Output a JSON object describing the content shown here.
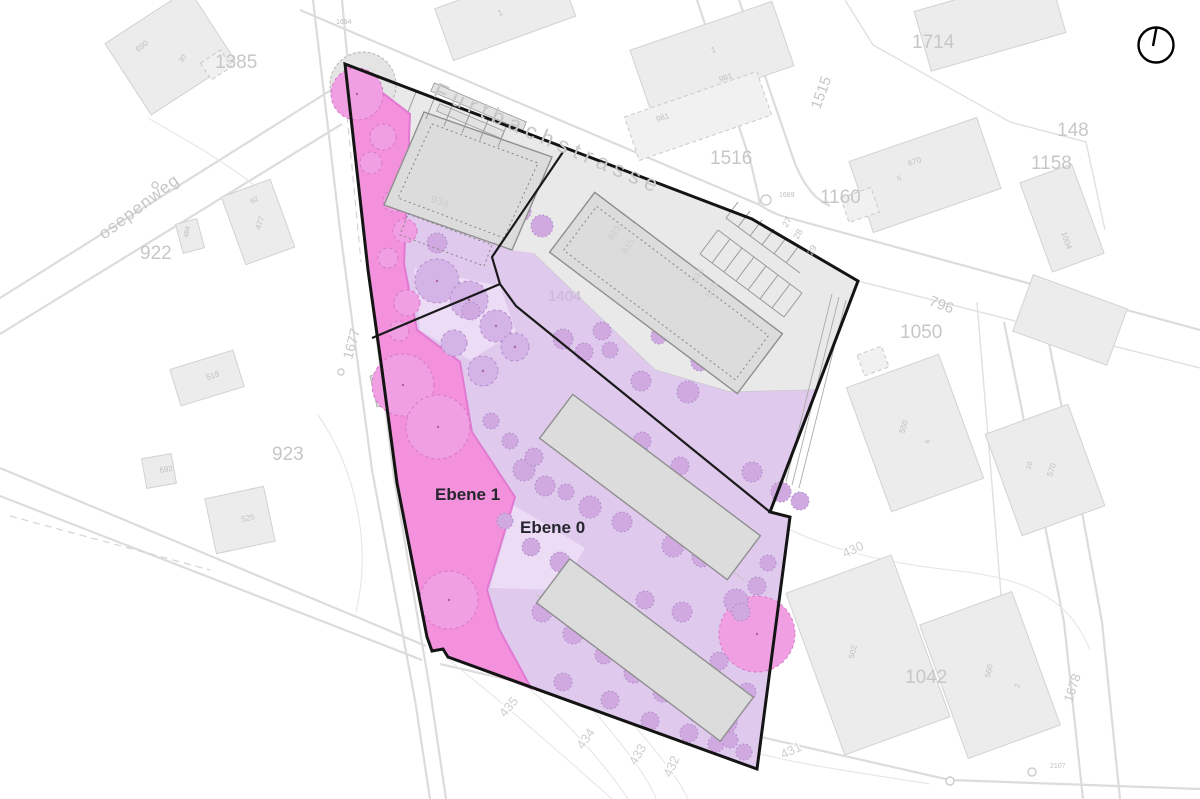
{
  "page": {
    "type": "architectural-site-plan"
  },
  "levels": {
    "ebene1": "Ebene 1",
    "ebene0": "Ebene 0"
  },
  "streets": {
    "furtbachstrasse": "Furtbachstrasse",
    "sidestreet": "osepenweg"
  },
  "parcels": {
    "p1385": "1385",
    "p1516": "1516",
    "p1160": "1160",
    "p1714": "1714",
    "p1158": "1158",
    "p148": "148",
    "p922": "922",
    "p923": "923",
    "p1050": "1050",
    "p1042": "1042",
    "p1404": "1404",
    "p796": "796",
    "p1515": "1515",
    "p1677": "1677",
    "p1678": "1678"
  },
  "map_labels": [
    {
      "t": "690",
      "x": 138,
      "y": 52,
      "s": 8,
      "r": -35
    },
    {
      "t": "30",
      "x": 182,
      "y": 63,
      "s": 7,
      "r": -55
    },
    {
      "t": "1",
      "x": 499,
      "y": 16,
      "s": 8,
      "r": -20
    },
    {
      "t": "1",
      "x": 712,
      "y": 53,
      "s": 8,
      "r": -18
    },
    {
      "t": "981",
      "x": 720,
      "y": 82,
      "s": 8,
      "r": -18
    },
    {
      "t": "981",
      "x": 657,
      "y": 122,
      "s": 8,
      "r": -18
    },
    {
      "t": "670",
      "x": 909,
      "y": 166,
      "s": 8,
      "r": -18
    },
    {
      "t": "5",
      "x": 898,
      "y": 181,
      "s": 7,
      "r": -18
    },
    {
      "t": "1004",
      "x": 1061,
      "y": 233,
      "s": 8,
      "r": 70
    },
    {
      "t": "82",
      "x": 252,
      "y": 204,
      "s": 7,
      "r": -30
    },
    {
      "t": "477",
      "x": 260,
      "y": 230,
      "s": 8,
      "r": -70
    },
    {
      "t": "484",
      "x": 188,
      "y": 238,
      "s": 7,
      "r": -80
    },
    {
      "t": "518",
      "x": 207,
      "y": 380,
      "s": 8,
      "r": -17
    },
    {
      "t": "525",
      "x": 242,
      "y": 522,
      "s": 8,
      "r": -12
    },
    {
      "t": "692",
      "x": 160,
      "y": 473,
      "s": 8,
      "r": -10
    },
    {
      "t": "550",
      "x": 904,
      "y": 434,
      "s": 8,
      "r": -72
    },
    {
      "t": "6",
      "x": 929,
      "y": 444,
      "s": 7,
      "r": -72
    },
    {
      "t": "570",
      "x": 1052,
      "y": 477,
      "s": 8,
      "r": -72
    },
    {
      "t": "10",
      "x": 1030,
      "y": 470,
      "s": 7,
      "r": -72
    },
    {
      "t": "502",
      "x": 854,
      "y": 659,
      "s": 8,
      "r": -78
    },
    {
      "t": "560",
      "x": 990,
      "y": 678,
      "s": 8,
      "r": -78
    },
    {
      "t": "2",
      "x": 1019,
      "y": 688,
      "s": 7,
      "r": -78
    },
    {
      "t": "1694",
      "x": 336,
      "y": 24,
      "s": 7,
      "r": 0
    },
    {
      "t": "1689",
      "x": 779,
      "y": 197,
      "s": 7,
      "r": 0
    },
    {
      "t": "2107",
      "x": 1050,
      "y": 768,
      "s": 7,
      "r": 0
    },
    {
      "t": "27",
      "x": 787,
      "y": 228,
      "s": 9,
      "r": -60
    },
    {
      "t": "28",
      "x": 798,
      "y": 240,
      "s": 9,
      "r": -60
    },
    {
      "t": "29",
      "x": 812,
      "y": 256,
      "s": 9,
      "r": -60
    },
    {
      "t": "93a",
      "x": 430,
      "y": 202,
      "s": 11,
      "r": 18,
      "c": "faint"
    },
    {
      "t": "B15",
      "x": 612,
      "y": 241,
      "s": 9,
      "r": -58,
      "c": "faint"
    },
    {
      "t": "B15",
      "x": 626,
      "y": 255,
      "s": 9,
      "r": -58,
      "c": "faint"
    },
    {
      "t": "B15",
      "x": 696,
      "y": 284,
      "s": 9,
      "r": -58,
      "c": "faint"
    },
    {
      "t": "B15",
      "x": 710,
      "y": 298,
      "s": 9,
      "r": -58,
      "c": "faint"
    },
    {
      "t": "435",
      "x": 505,
      "y": 718,
      "s": 13,
      "r": -50,
      "c": "contour"
    },
    {
      "t": "434",
      "x": 583,
      "y": 750,
      "s": 13,
      "r": -55,
      "c": "contour"
    },
    {
      "t": "433",
      "x": 636,
      "y": 766,
      "s": 13,
      "r": -60,
      "c": "contour"
    },
    {
      "t": "432",
      "x": 671,
      "y": 778,
      "s": 13,
      "r": -66,
      "c": "contour"
    },
    {
      "t": "431",
      "x": 783,
      "y": 759,
      "s": 13,
      "r": -25,
      "c": "contour"
    },
    {
      "t": "430",
      "x": 845,
      "y": 558,
      "s": 13,
      "r": -25,
      "c": "contour"
    }
  ],
  "trees": {
    "pink": [
      [
        357,
        94,
        26
      ],
      [
        383,
        137,
        13
      ],
      [
        371,
        163,
        11
      ],
      [
        394,
        201,
        11
      ],
      [
        405,
        231,
        12
      ],
      [
        388,
        258,
        10
      ],
      [
        407,
        303,
        13
      ],
      [
        399,
        331,
        10
      ],
      [
        403,
        385,
        31
      ],
      [
        438,
        427,
        32
      ],
      [
        449,
        600,
        29
      ],
      [
        757,
        634,
        38
      ]
    ],
    "purple_big": [
      [
        437,
        281,
        22
      ],
      [
        469,
        300,
        19
      ],
      [
        496,
        326,
        16
      ],
      [
        454,
        343,
        13
      ],
      [
        515,
        347,
        14
      ],
      [
        483,
        371,
        15
      ]
    ],
    "purple_small": [
      [
        466,
        190,
        10
      ],
      [
        452,
        216,
        11
      ],
      [
        437,
        243,
        10
      ],
      [
        499,
        196,
        12
      ],
      [
        520,
        211,
        11
      ],
      [
        542,
        226,
        11
      ],
      [
        563,
        339,
        10
      ],
      [
        584,
        352,
        9
      ],
      [
        610,
        350,
        8
      ],
      [
        641,
        381,
        10
      ],
      [
        688,
        392,
        11
      ],
      [
        471,
        311,
        9
      ],
      [
        602,
        331,
        9
      ],
      [
        659,
        336,
        8
      ],
      [
        700,
        362,
        9
      ],
      [
        524,
        470,
        11
      ],
      [
        545,
        486,
        10
      ],
      [
        590,
        507,
        11
      ],
      [
        622,
        522,
        10
      ],
      [
        673,
        546,
        11
      ],
      [
        702,
        557,
        10
      ],
      [
        736,
        601,
        12
      ],
      [
        682,
        612,
        10
      ],
      [
        645,
        600,
        9
      ],
      [
        560,
        562,
        10
      ],
      [
        531,
        547,
        9
      ],
      [
        505,
        521,
        8
      ],
      [
        542,
        612,
        10
      ],
      [
        573,
        634,
        10
      ],
      [
        604,
        655,
        9
      ],
      [
        634,
        673,
        10
      ],
      [
        663,
        692,
        10
      ],
      [
        697,
        712,
        10
      ],
      [
        727,
        723,
        10
      ],
      [
        747,
        692,
        9
      ],
      [
        719,
        661,
        9
      ],
      [
        563,
        682,
        9
      ],
      [
        610,
        700,
        9
      ],
      [
        650,
        721,
        9
      ],
      [
        689,
        733,
        9
      ],
      [
        716,
        744,
        8
      ],
      [
        752,
        472,
        10
      ],
      [
        781,
        492,
        10
      ],
      [
        800,
        501,
        9
      ],
      [
        642,
        441,
        9
      ],
      [
        680,
        466,
        9
      ],
      [
        612,
        471,
        8
      ],
      [
        491,
        421,
        8
      ],
      [
        510,
        441,
        8
      ],
      [
        534,
        457,
        9
      ],
      [
        566,
        492,
        8
      ],
      [
        757,
        586,
        9
      ],
      [
        768,
        563,
        8
      ],
      [
        741,
        612,
        9
      ],
      [
        730,
        740,
        8
      ],
      [
        744,
        752,
        8
      ]
    ]
  },
  "colors": {
    "ebene1_fill": "#f491dc",
    "ebene1_border": "#e279d2",
    "ebene0_fill": "#dfc9ed",
    "site_gray": "#e9e9e9",
    "boundary_black": "#141414",
    "tree_pink": "#ef9fe2",
    "tree_purple": "#cfa9e0",
    "label_gray": "#c7c7c7"
  },
  "icons": {
    "north_arrow": "compass circle with north tick"
  }
}
